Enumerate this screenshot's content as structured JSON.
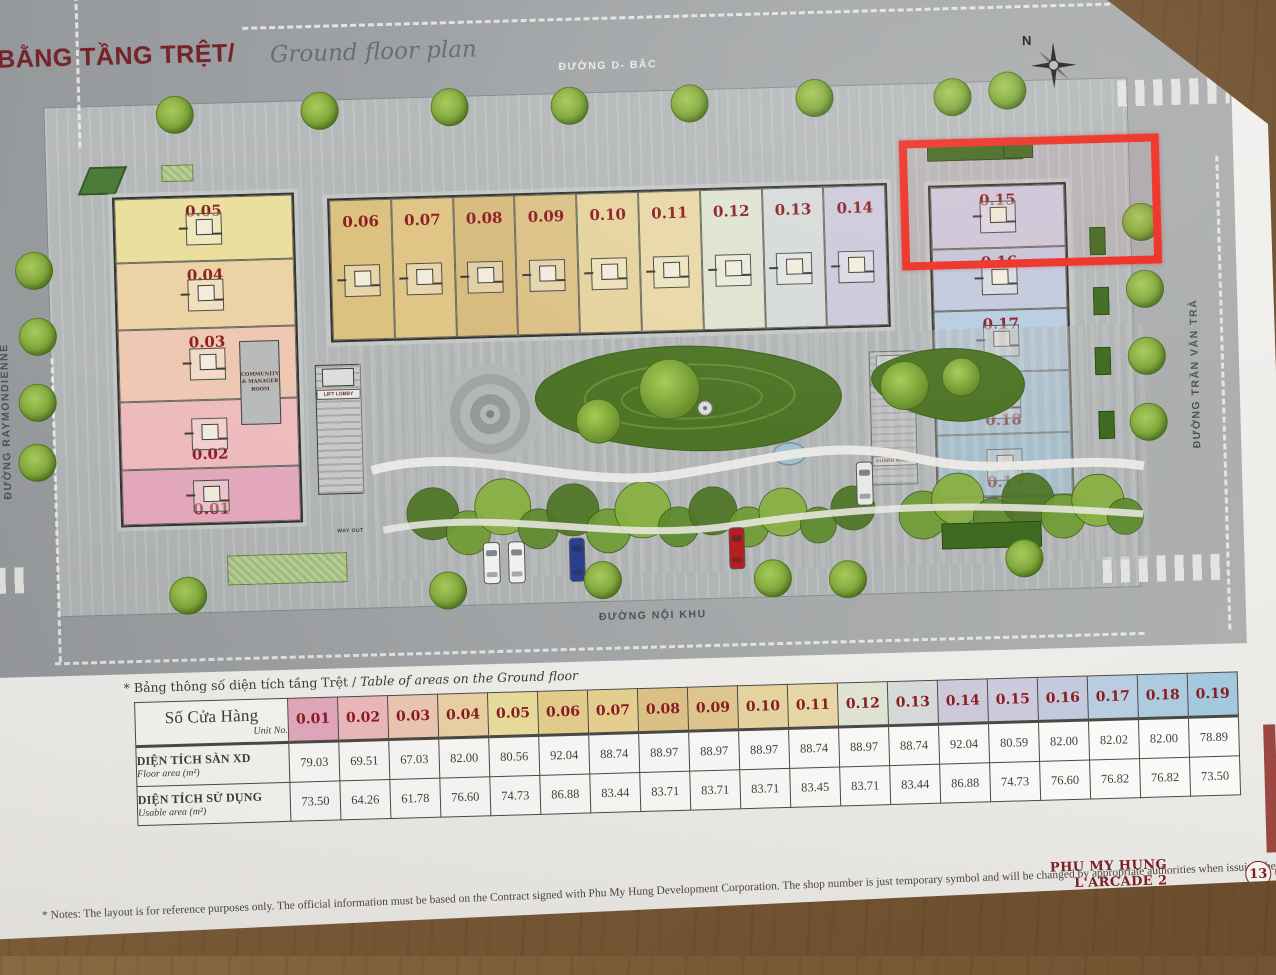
{
  "page": {
    "title_vi": "MẶT BẰNG TẦNG TRỆT/",
    "title_en": "Ground floor plan",
    "north_label": "N",
    "streets": {
      "top": "ĐƯỜNG D- BẮC",
      "bottom": "ĐƯỜNG NỘI KHU",
      "left": "ĐƯỜNG RAYMONDIENNE",
      "right": "ĐƯỜNG TRẦN VĂN TRÀ"
    },
    "notes": "* Notes: The layout is for reference purposes only. The official information must be based on the Contract signed with Phu My Hung Development Corporation. The shop number is just temporary symbol and will be changed by appropriate authorities when issuing the official one.",
    "footer": {
      "brand_line1": "PHU MY HUNG",
      "brand_line2": "L'ARCADE 2",
      "page_number": "13"
    }
  },
  "plan": {
    "highlight_color": "#ee2e24",
    "labels": {
      "lift_lobby": "LIFT LOBBY",
      "guard_house": "GUARD HOUSE",
      "community_room": "COMMUNITY & MANAGER ROOM",
      "way_out": "WAY OUT"
    },
    "left_block": [
      {
        "unit": "0.05",
        "color": "#ebdf9d"
      },
      {
        "unit": "0.04",
        "color": "#edd2a6"
      },
      {
        "unit": "0.03",
        "color": "#eec8b2"
      },
      {
        "unit": "0.02",
        "color": "#eebbbe"
      },
      {
        "unit": "0.01",
        "color": "#e5a9bd"
      }
    ],
    "top_block": [
      {
        "unit": "0.06",
        "color": "#ddc180"
      },
      {
        "unit": "0.07",
        "color": "#e0c586"
      },
      {
        "unit": "0.08",
        "color": "#d8bb7e"
      },
      {
        "unit": "0.09",
        "color": "#dcc287"
      },
      {
        "unit": "0.10",
        "color": "#e6d49e"
      },
      {
        "unit": "0.11",
        "color": "#e9d8a7"
      },
      {
        "unit": "0.12",
        "color": "#dfe4d1"
      },
      {
        "unit": "0.13",
        "color": "#d6dbd9"
      },
      {
        "unit": "0.14",
        "color": "#cccadb"
      }
    ],
    "right_block": [
      {
        "unit": "0.15",
        "color": "#cdcadd"
      },
      {
        "unit": "0.16",
        "color": "#c3c9de"
      },
      {
        "unit": "0.17",
        "color": "#b8cde1"
      },
      {
        "unit": "0.18",
        "color": "#adcbdf"
      },
      {
        "unit": "0.19",
        "color": "#a2c9de"
      }
    ]
  },
  "table": {
    "caption_vi": "* Bảng thông số diện tích tầng Trệt / ",
    "caption_en": "Table of areas on the Ground floor",
    "header": {
      "vi": "Số Cửa Hàng",
      "en": "Unit No."
    },
    "row_labels": [
      {
        "vi": "DIỆN TÍCH SÀN XD",
        "en": "Floor area (m²)"
      },
      {
        "vi": "DIỆN TÍCH SỬ DỤNG",
        "en": "Usable area (m²)"
      }
    ],
    "units": [
      "0.01",
      "0.02",
      "0.03",
      "0.04",
      "0.05",
      "0.06",
      "0.07",
      "0.08",
      "0.09",
      "0.10",
      "0.11",
      "0.12",
      "0.13",
      "0.14",
      "0.15",
      "0.16",
      "0.17",
      "0.18",
      "0.19"
    ],
    "unit_colors": [
      "#e5a9bd",
      "#eebbbe",
      "#eec8b2",
      "#edd2a6",
      "#ebdf9d",
      "#e6cf8d",
      "#e8d191",
      "#dec387",
      "#e0c88f",
      "#e7d5a0",
      "#e9d8a8",
      "#e0e5d3",
      "#d6dbd9",
      "#cccadb",
      "#cdcadd",
      "#c4cade",
      "#b9cde1",
      "#adcbdf",
      "#a2c9de"
    ],
    "floor_area": [
      "79.03",
      "69.51",
      "67.03",
      "82.00",
      "80.56",
      "92.04",
      "88.74",
      "88.97",
      "88.97",
      "88.97",
      "88.74",
      "88.97",
      "88.74",
      "92.04",
      "80.59",
      "82.00",
      "82.02",
      "82.00",
      "78.89"
    ],
    "usable_area": [
      "73.50",
      "64.26",
      "61.78",
      "76.60",
      "74.73",
      "86.88",
      "83.44",
      "83.71",
      "83.71",
      "83.71",
      "83.45",
      "83.71",
      "83.44",
      "86.88",
      "74.73",
      "76.60",
      "76.82",
      "76.82",
      "73.50"
    ]
  }
}
